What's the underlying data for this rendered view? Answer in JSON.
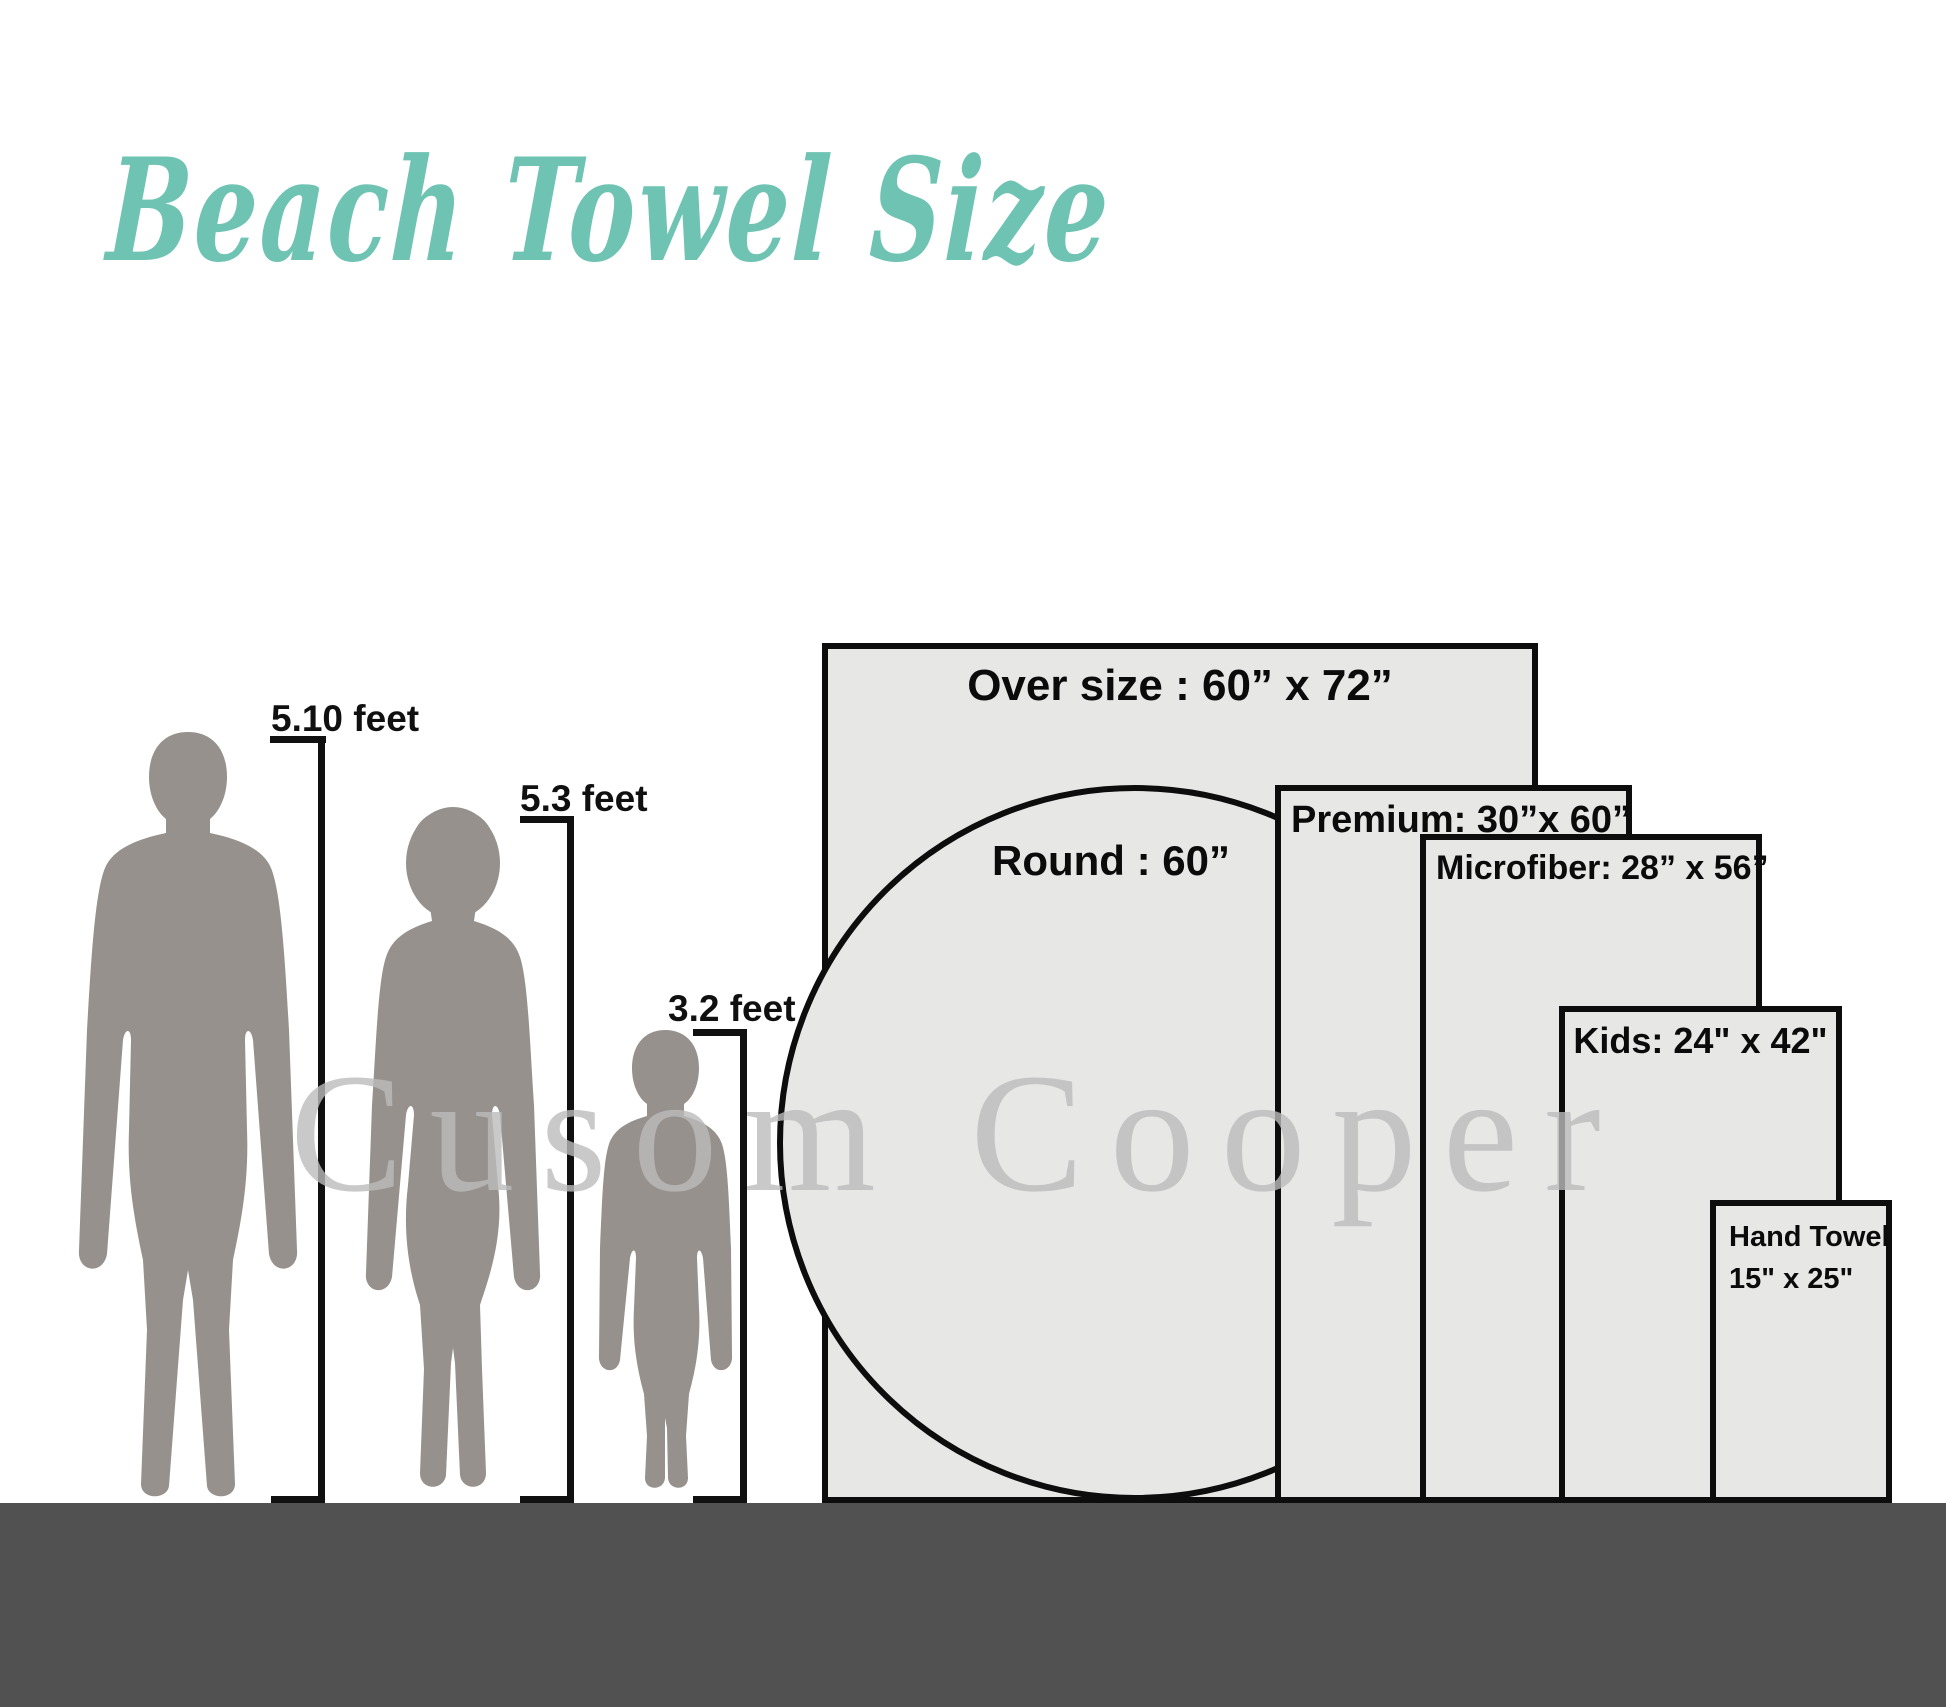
{
  "title": {
    "text": "Beach Towel Size"
  },
  "watermark": {
    "text": "Cusom Cooper"
  },
  "people": {
    "man": {
      "height_label": "5.10 feet"
    },
    "woman": {
      "height_label": "5.3 feet"
    },
    "child": {
      "height_label": "3.2 feet"
    }
  },
  "towels": {
    "oversize": {
      "label": "Over size : 60” x 72”"
    },
    "round": {
      "label": "Round : 60”"
    },
    "premium": {
      "label": "Premium: 30”x 60”"
    },
    "microfiber": {
      "label": "Microfiber: 28” x 56”"
    },
    "kids": {
      "label": "Kids: 24\" x 42\""
    },
    "hand_towel": {
      "label_line1": "Hand Towel",
      "label_line2": "15\" x 25\""
    }
  },
  "colors": {
    "title_accent": "#6EC3B3",
    "silhouette": "#96918D",
    "towel_fill": "#E7E7E6",
    "towel_border": "#0D0D0D",
    "ground": "#515151",
    "watermark": "#BBBBBB",
    "label_text": "#0B0B0B"
  }
}
